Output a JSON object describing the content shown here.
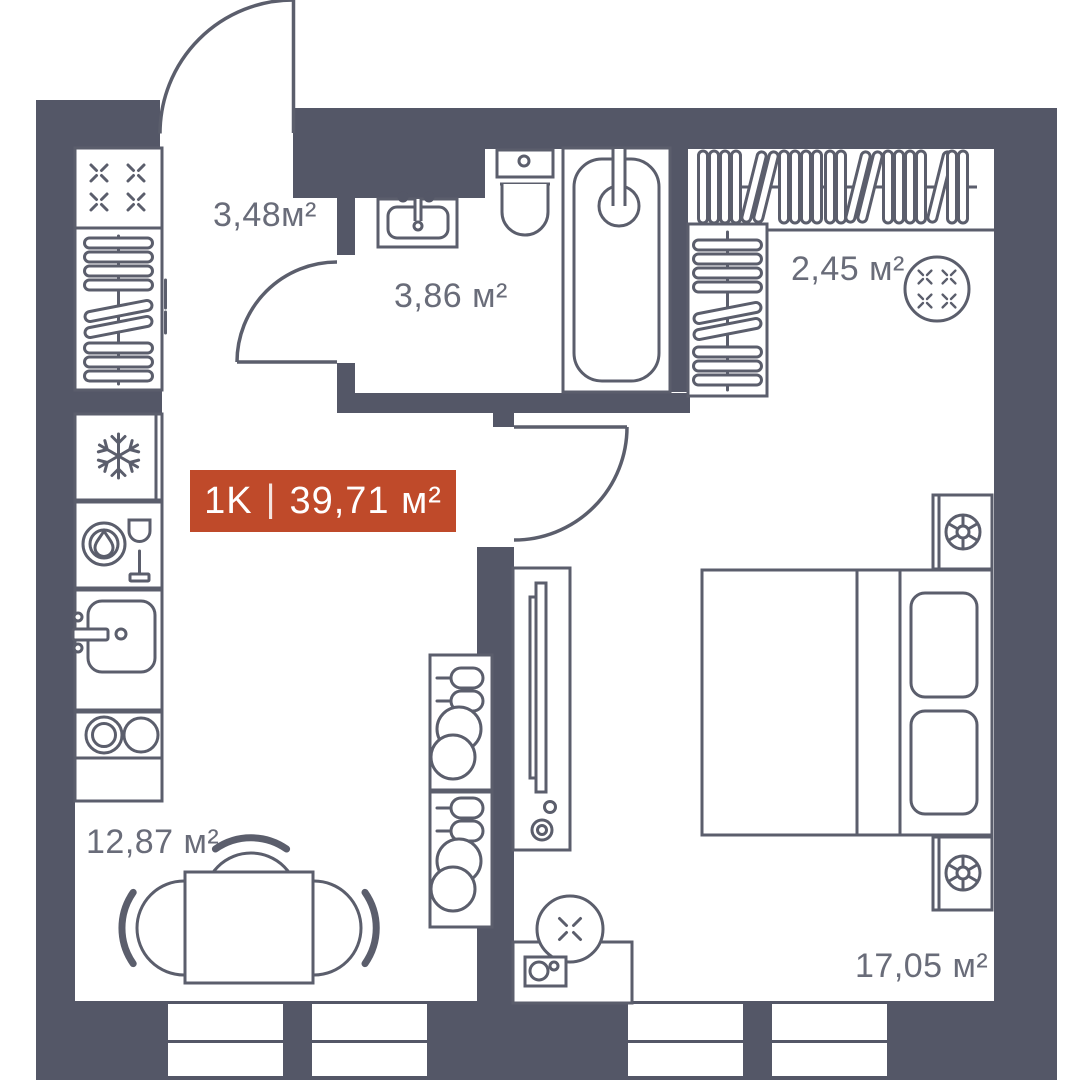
{
  "plan": {
    "badge": {
      "unit_type": "1K",
      "separator": "|",
      "area": "39,71 м²"
    },
    "rooms": {
      "hallway": {
        "area_label": "3,48м²"
      },
      "bathroom": {
        "area_label": "3,86 м²"
      },
      "wardrobe": {
        "area_label": "2,45 м²"
      },
      "kitchen_living": {
        "area_label": "12,87 м²"
      },
      "bedroom": {
        "area_label": "17,05 м²"
      }
    },
    "colors": {
      "wall": "#545767",
      "line": "#5b5e6c",
      "label": "#696c79",
      "accent": "#bf4a2a",
      "accent_text": "#ffffff",
      "background": "#ffffff"
    },
    "icons": [
      "entrance-door-arc",
      "interior-door-arc",
      "bathroom-door-arc",
      "stove-burners-icon",
      "hanger-rail-icon",
      "fridge-snowflake-icon",
      "dishwasher-icon",
      "kitchen-sink-icon",
      "hob-rings-icon",
      "dining-table",
      "chair-icon",
      "shelf-glasses-icon",
      "tv-stand-icon",
      "washing-machine-icon",
      "bed",
      "pillow",
      "nightstand-lamp-icon",
      "vanity-sink-icon",
      "toilet-icon",
      "bathtub-icon",
      "window-bars"
    ]
  }
}
